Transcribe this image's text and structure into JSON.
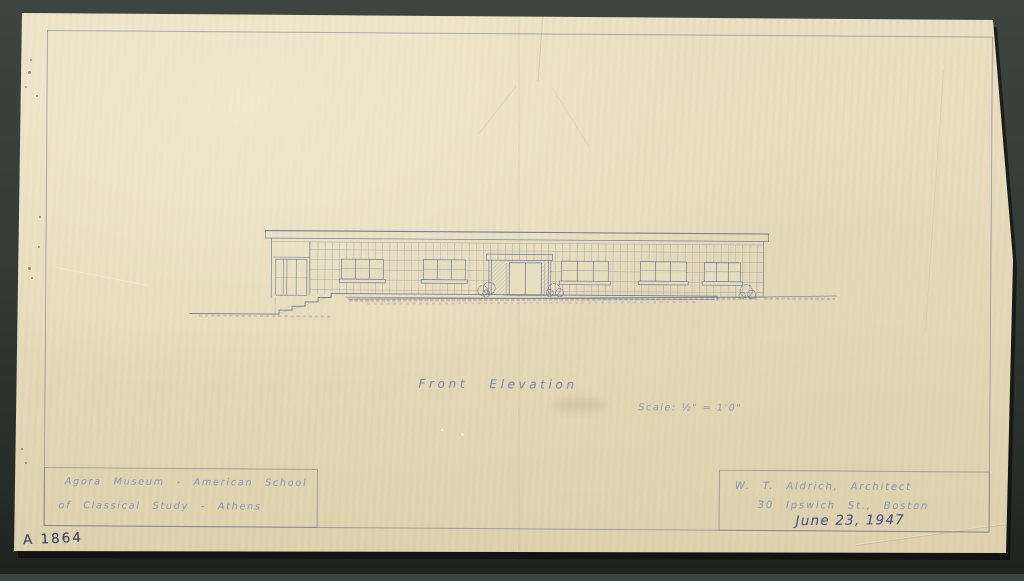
{
  "sheet": {
    "catalog_number": "A 1864",
    "caption": {
      "title": "Front Elevation",
      "scale": "Scale: ½\" = 1'0\""
    },
    "title_block_project": {
      "line1": "Agora Museum - American School",
      "line2": "of Classical Study - Athens"
    },
    "title_block_architect": {
      "architect": "W. T. Aldrich, Architect",
      "address": "30 Ipswich St., Boston",
      "date": "June 23, 1947"
    },
    "colors": {
      "paper": "#e5dabb",
      "mount_background": "#333935",
      "pencil_blue": "#67738f",
      "pencil_faint": "#949cb0",
      "ink_dark": "#4f588a"
    }
  }
}
